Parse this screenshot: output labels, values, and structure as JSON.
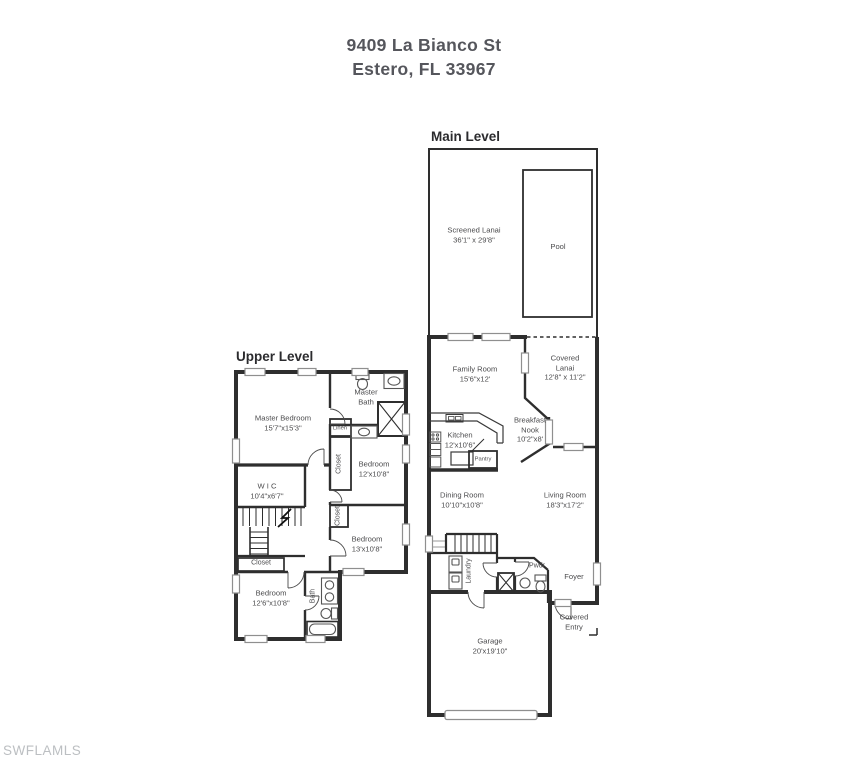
{
  "title": {
    "line1": "9409 La Bianco St",
    "line2": "Estero, FL 33967"
  },
  "watermark": "SWFLAMLS",
  "colors": {
    "wall": "#2e2e2e",
    "label_text": "#4c4c4e",
    "title_text": "#55565c",
    "watermark_text": "#bcbfc2",
    "window_outline": "#8f8f8f",
    "fixture_outline": "#555555"
  },
  "main_level": {
    "label": "Main Level",
    "rooms": {
      "screened_lanai": {
        "name": "Screened Lanai",
        "dims": "36'1\" x 29'8\""
      },
      "pool": {
        "name": "Pool"
      },
      "family_room": {
        "name": "Family Room",
        "dims": "15'6\"x12'"
      },
      "covered_lanai": {
        "name": "Covered",
        "name2": "Lanai",
        "dims": "12'8\" x 11'2\""
      },
      "breakfast_nook": {
        "name": "Breakfast",
        "name2": "Nook",
        "dims": "10'2\"x8'"
      },
      "kitchen": {
        "name": "Kitchen",
        "dims": "12'x10'6\""
      },
      "pantry": {
        "name": "Pantry"
      },
      "dining_room": {
        "name": "Dining Room",
        "dims": "10'10\"x10'8\""
      },
      "living_room": {
        "name": "Living Room",
        "dims": "18'3\"x17'2\""
      },
      "laundry": {
        "name": "Laundry"
      },
      "powder": {
        "name": "Pwdr"
      },
      "foyer": {
        "name": "Foyer"
      },
      "covered_entry": {
        "name": "Covered",
        "name2": "Entry"
      },
      "garage": {
        "name": "Garage",
        "dims": "20'x19'10\""
      }
    }
  },
  "upper_level": {
    "label": "Upper Level",
    "rooms": {
      "master_bedroom": {
        "name": "Master Bedroom",
        "dims": "15'7\"x15'3\""
      },
      "master_bath": {
        "name": "Master",
        "name2": "Bath"
      },
      "linen": {
        "name": "Linen"
      },
      "closet_bedroom2": {
        "name": "Closet"
      },
      "bedroom2": {
        "name": "Bedroom",
        "dims": "12'x10'8\""
      },
      "wic": {
        "name": "W I C",
        "dims": "10'4\"x6'7\""
      },
      "closet_bedroom3": {
        "name": "Closet"
      },
      "bedroom3": {
        "name": "Bedroom",
        "dims": "13'x10'8\""
      },
      "closet_bedroom4": {
        "name": "Closet"
      },
      "bedroom4": {
        "name": "Bedroom",
        "dims": "12'6\"x10'8\""
      },
      "bath": {
        "name": "Bath"
      }
    }
  }
}
